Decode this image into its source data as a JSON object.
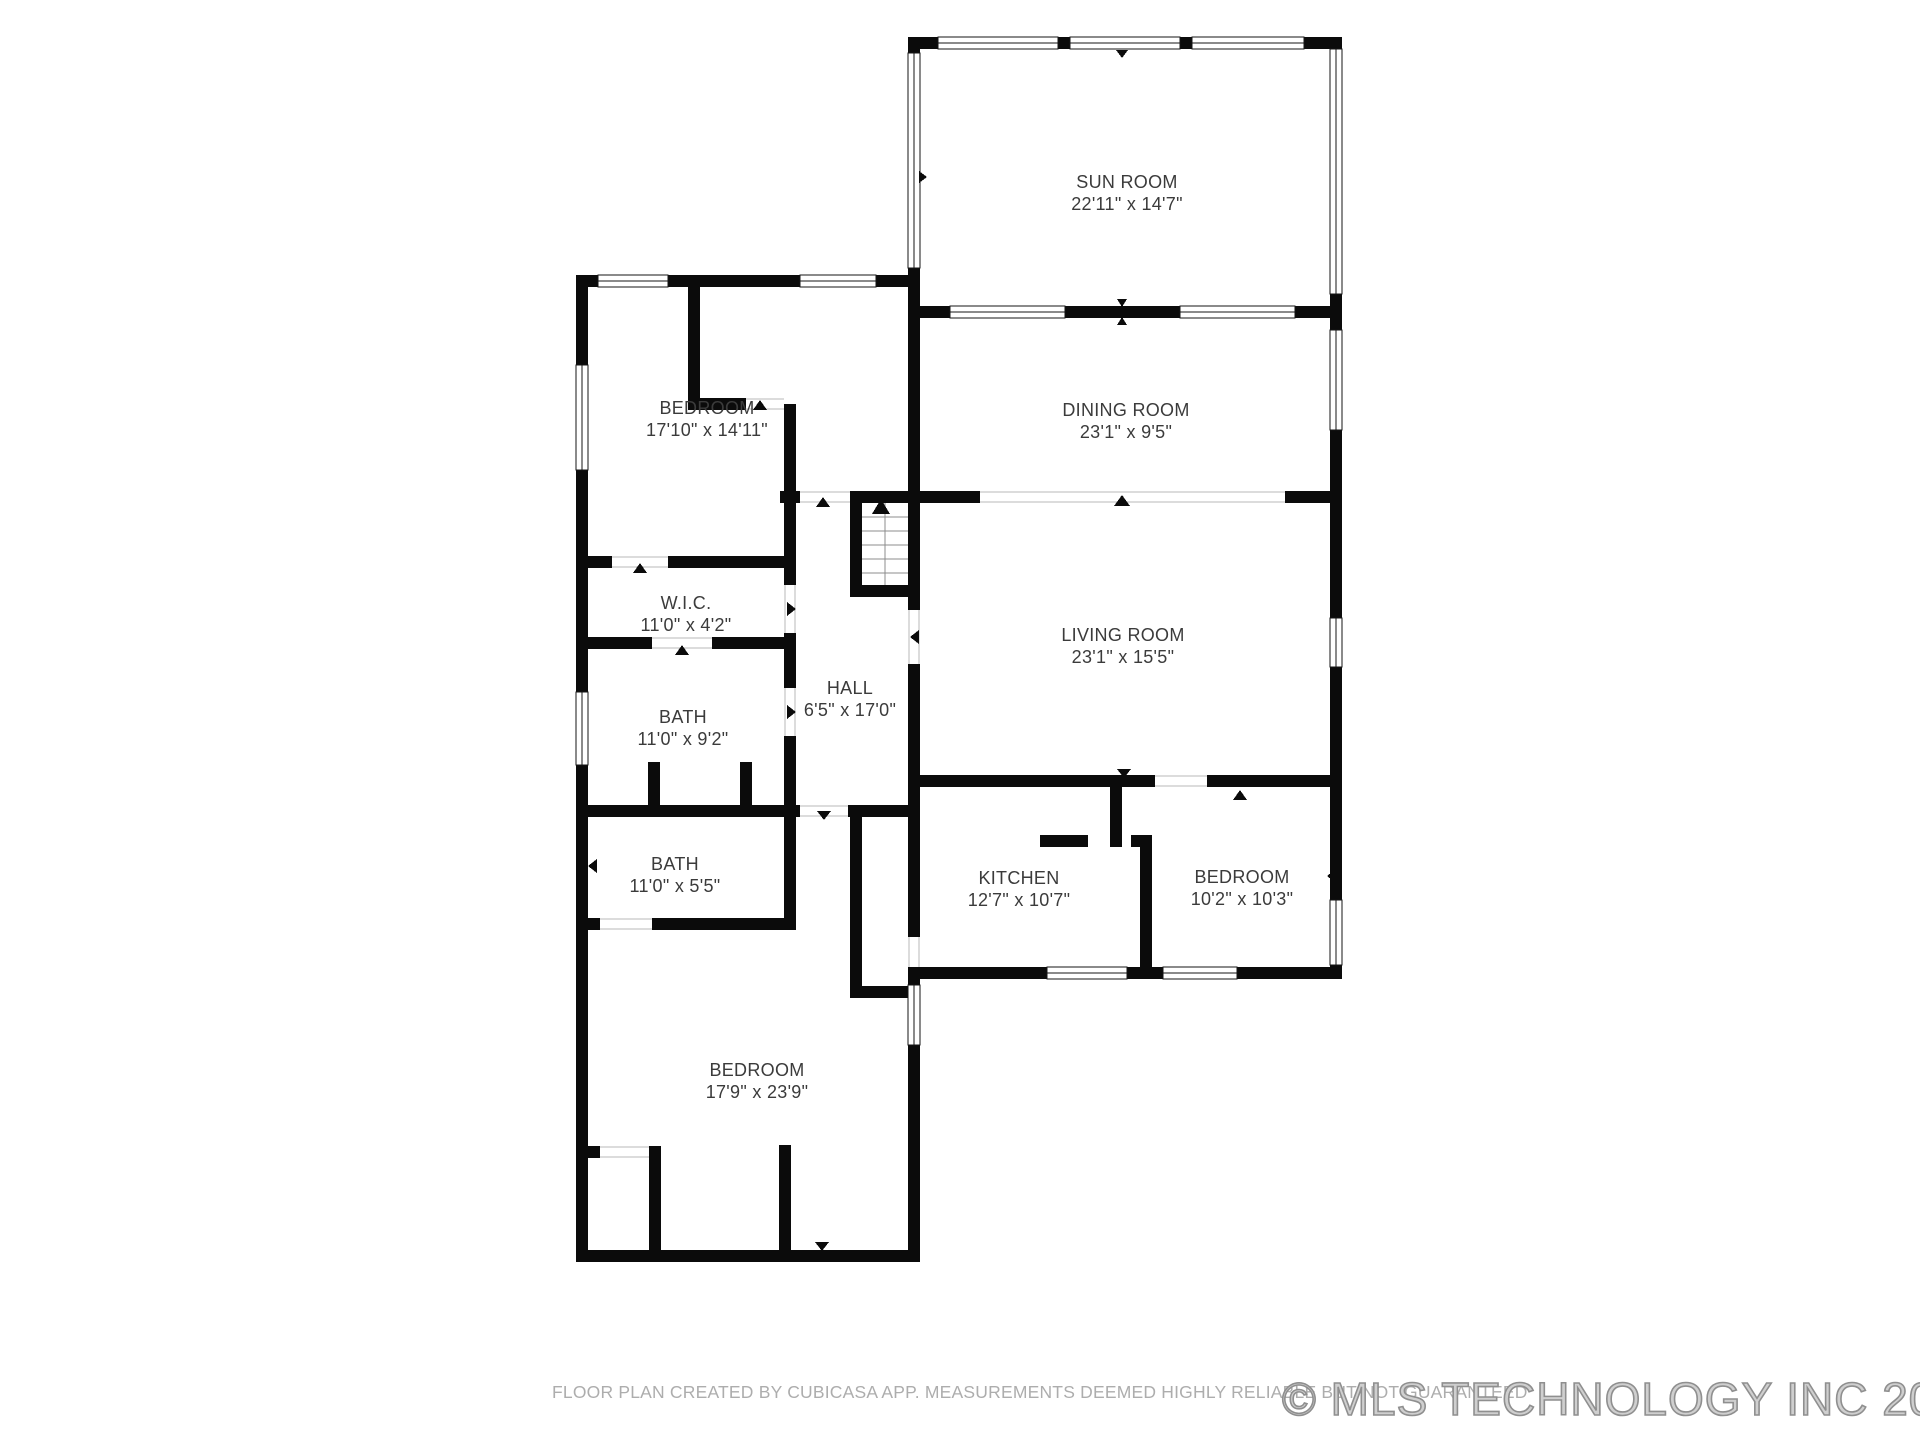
{
  "rooms": [
    {
      "id": "sun-room",
      "name": "SUN ROOM",
      "dims": "22'11\" x 14'7\""
    },
    {
      "id": "bedroom-upper",
      "name": "BEDROOM",
      "dims": "17'10\" x 14'11\""
    },
    {
      "id": "dining-room",
      "name": "DINING ROOM",
      "dims": "23'1\" x 9'5\""
    },
    {
      "id": "wic",
      "name": "W.I.C.",
      "dims": "11'0\" x 4'2\""
    },
    {
      "id": "bath-upper",
      "name": "BATH",
      "dims": "11'0\" x 9'2\""
    },
    {
      "id": "hall",
      "name": "HALL",
      "dims": "6'5\" x 17'0\""
    },
    {
      "id": "living-room",
      "name": "LIVING ROOM",
      "dims": "23'1\" x 15'5\""
    },
    {
      "id": "bath-lower",
      "name": "BATH",
      "dims": "11'0\" x 5'5\""
    },
    {
      "id": "kitchen",
      "name": "KITCHEN",
      "dims": "12'7\" x 10'7\""
    },
    {
      "id": "bedroom-right",
      "name": "BEDROOM",
      "dims": "10'2\" x 10'3\""
    },
    {
      "id": "bedroom-lower",
      "name": "BEDROOM",
      "dims": "17'9\" x 23'9\""
    }
  ],
  "footer": {
    "disclaimer": "FLOOR PLAN CREATED BY CUBICASA APP. MEASUREMENTS DEEMED HIGHLY RELIABLE BUT NOT GUARANTEED"
  },
  "watermark": {
    "text": "© MLS TECHNOLOGY INC 2026"
  },
  "colors": {
    "wall": "#0b0b0b",
    "label_text": "#3b3b3b",
    "muted_text": "#adadad",
    "watermark_gray": "#8f8f8f",
    "background": "#ffffff"
  }
}
